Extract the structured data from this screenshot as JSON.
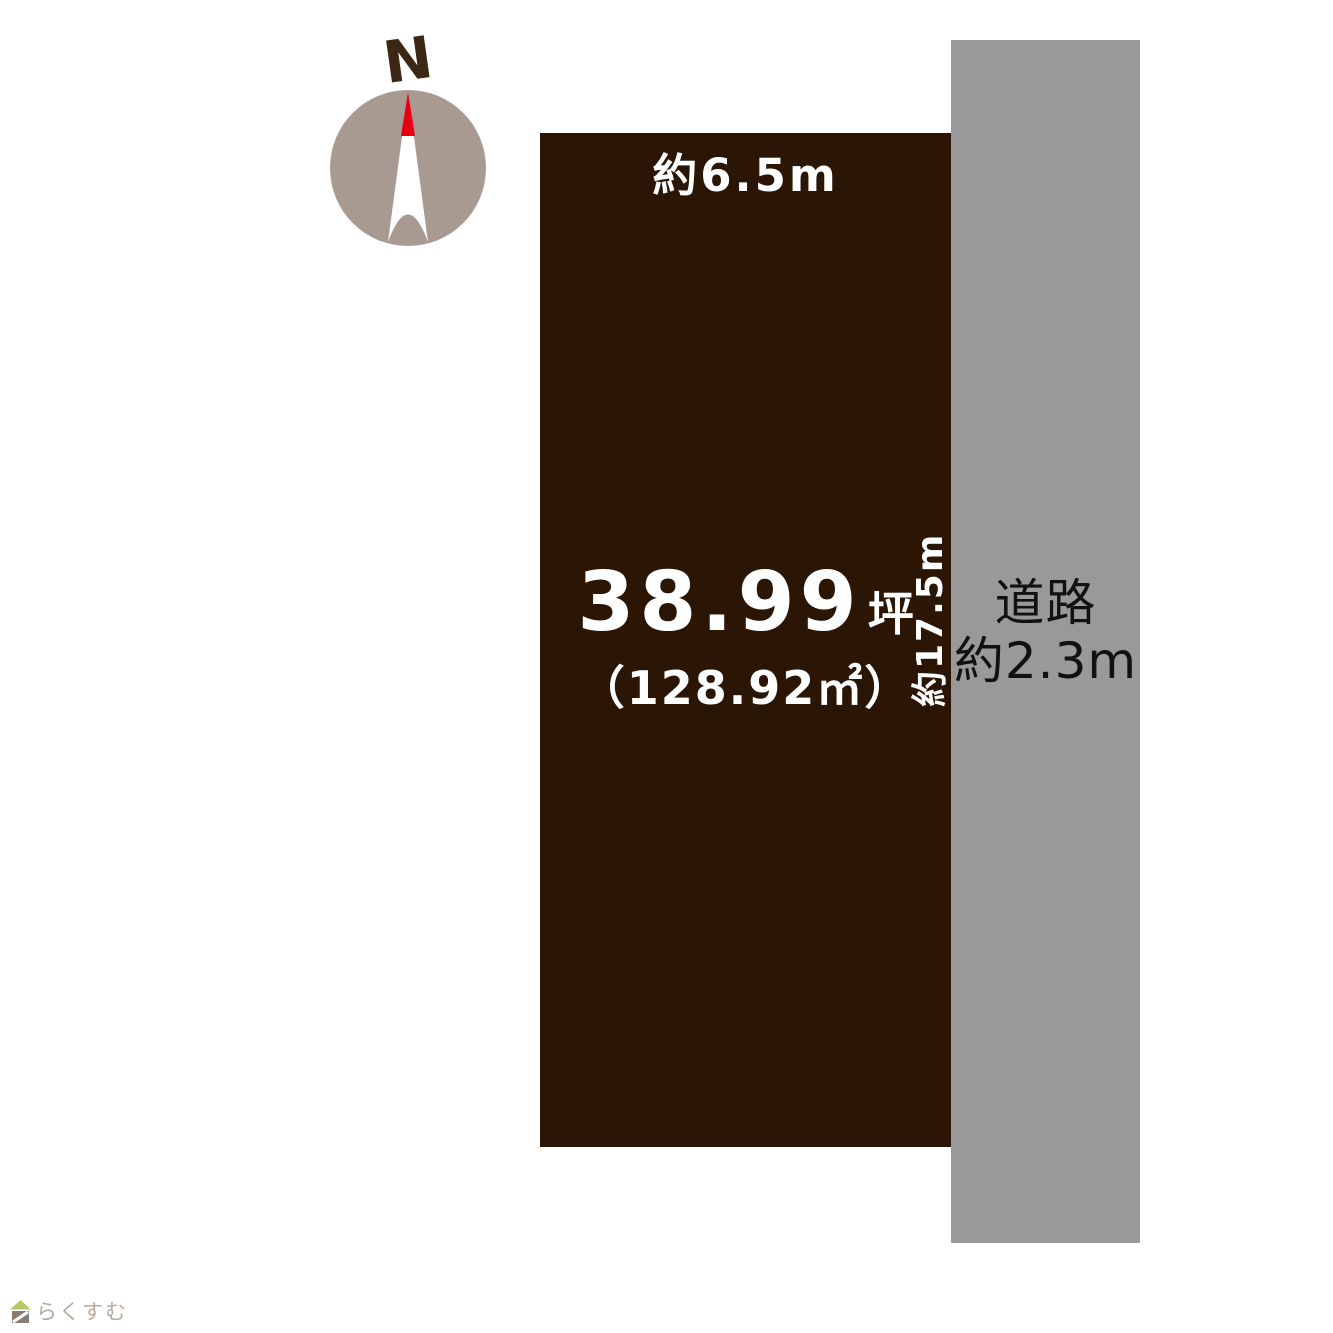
{
  "compass": {
    "north_label": "N"
  },
  "plot": {
    "top_dimension": "約6.5m",
    "right_dimension": "約17.5m",
    "area_tsubo": "38.99",
    "area_tsubo_unit": "坪",
    "area_sqm": "（128.92㎡）"
  },
  "road": {
    "name": "道路",
    "width": "約2.3m"
  },
  "footer": {
    "brand": "らくすむ"
  },
  "colors": {
    "plot_brown": "#2b1505",
    "road_gray": "#999999",
    "compass_circle": "#a89a90",
    "needle_red": "#e60012",
    "north_letter": "#3a2815",
    "text_on_plot": "#ffffff",
    "road_text": "#111111",
    "brand_text": "#b4aba3"
  }
}
